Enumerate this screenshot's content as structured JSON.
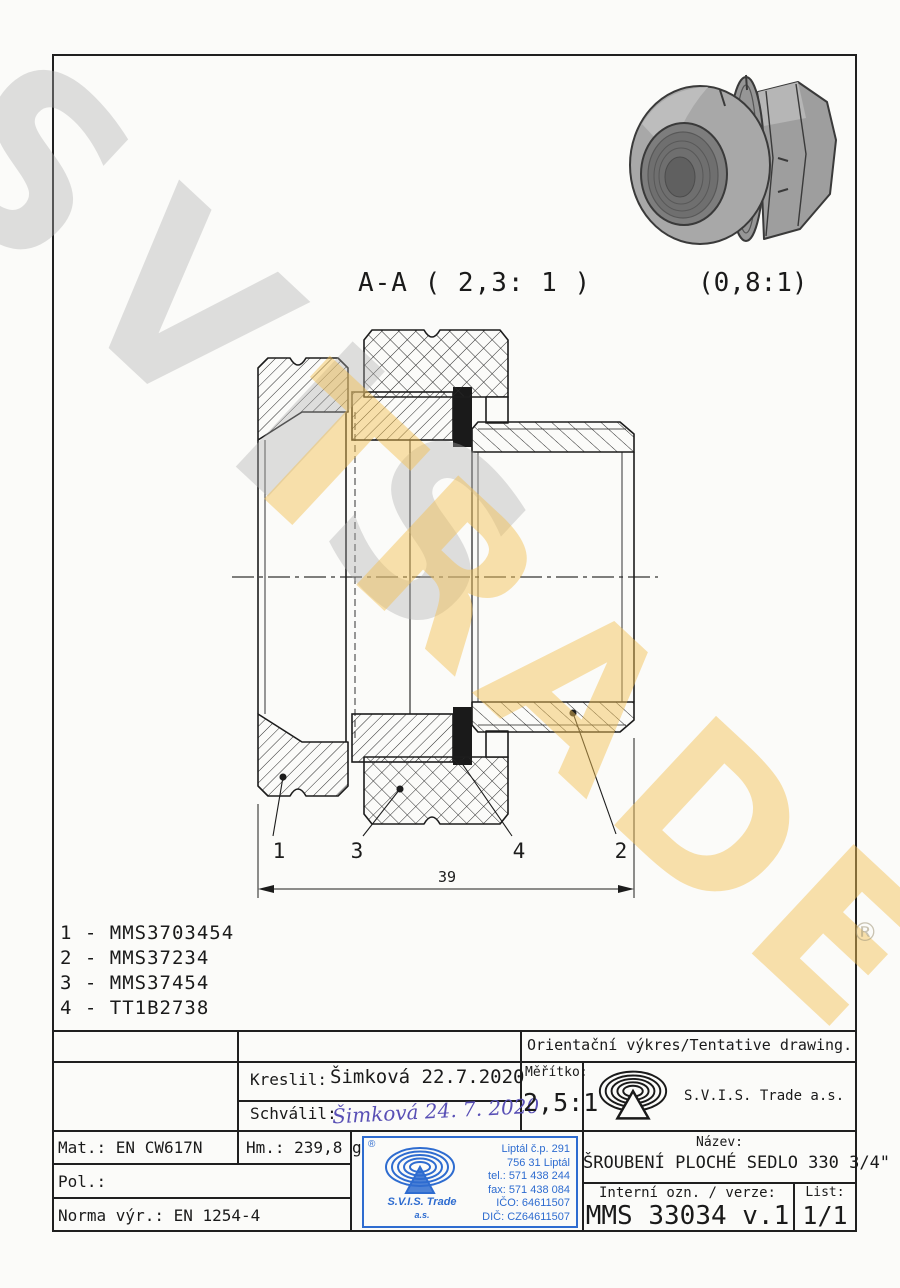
{
  "watermark": {
    "word1": "SVIS",
    "word2": "TRADE",
    "registered": "®"
  },
  "views": {
    "section_title": "A-A ( 2,3: 1 )",
    "photo_scale": "(0,8:1)",
    "dim_39": "39",
    "label_1": "1",
    "label_2": "2",
    "label_3": "3",
    "label_4": "4"
  },
  "parts_list": {
    "line1": "1 - MMS3703454",
    "line2": "2 - MMS37234",
    "line3": "3 - MMS37454",
    "line4": "4 - TT1B2738"
  },
  "title_block": {
    "tentative": "Orientační výkres/Tentative drawing.",
    "kreslil_label": "Kreslil:",
    "kreslil_value": "Šimková 22.7.2020",
    "schvalil_label": "Schválil:",
    "schvalil_value": "Šimková 24. 7. 2020",
    "meritko_label": "Měřítko:",
    "meritko_value": "2,5:1",
    "company": "S.V.I.S. Trade a.s.",
    "mat": "Mat.: EN CW617N",
    "hm": "Hm.: 239,8 g",
    "pol": "Pol.:",
    "norma": "Norma výr.: EN 1254-4",
    "nazev_label": "Název:",
    "nazev_value": "ŠROUBENÍ PLOCHÉ SEDLO 330 3/4\"",
    "interni_label": "Interní ozn. / verze:",
    "interni_value": "MMS 33034 v.1",
    "list_label": "List:",
    "list_value": "1/1"
  },
  "stamp": {
    "registered": "®",
    "company_line1": "S.V.I.S. Trade",
    "company_line2": "a.s.",
    "addr1": "Liptál č.p. 291",
    "addr2": "756 31 Liptál",
    "addr3": "tel.: 571 438 244",
    "addr4": "fax: 571 438 084",
    "addr5": "IČO: 64611507",
    "addr6": "DIČ: CZ64611507"
  }
}
